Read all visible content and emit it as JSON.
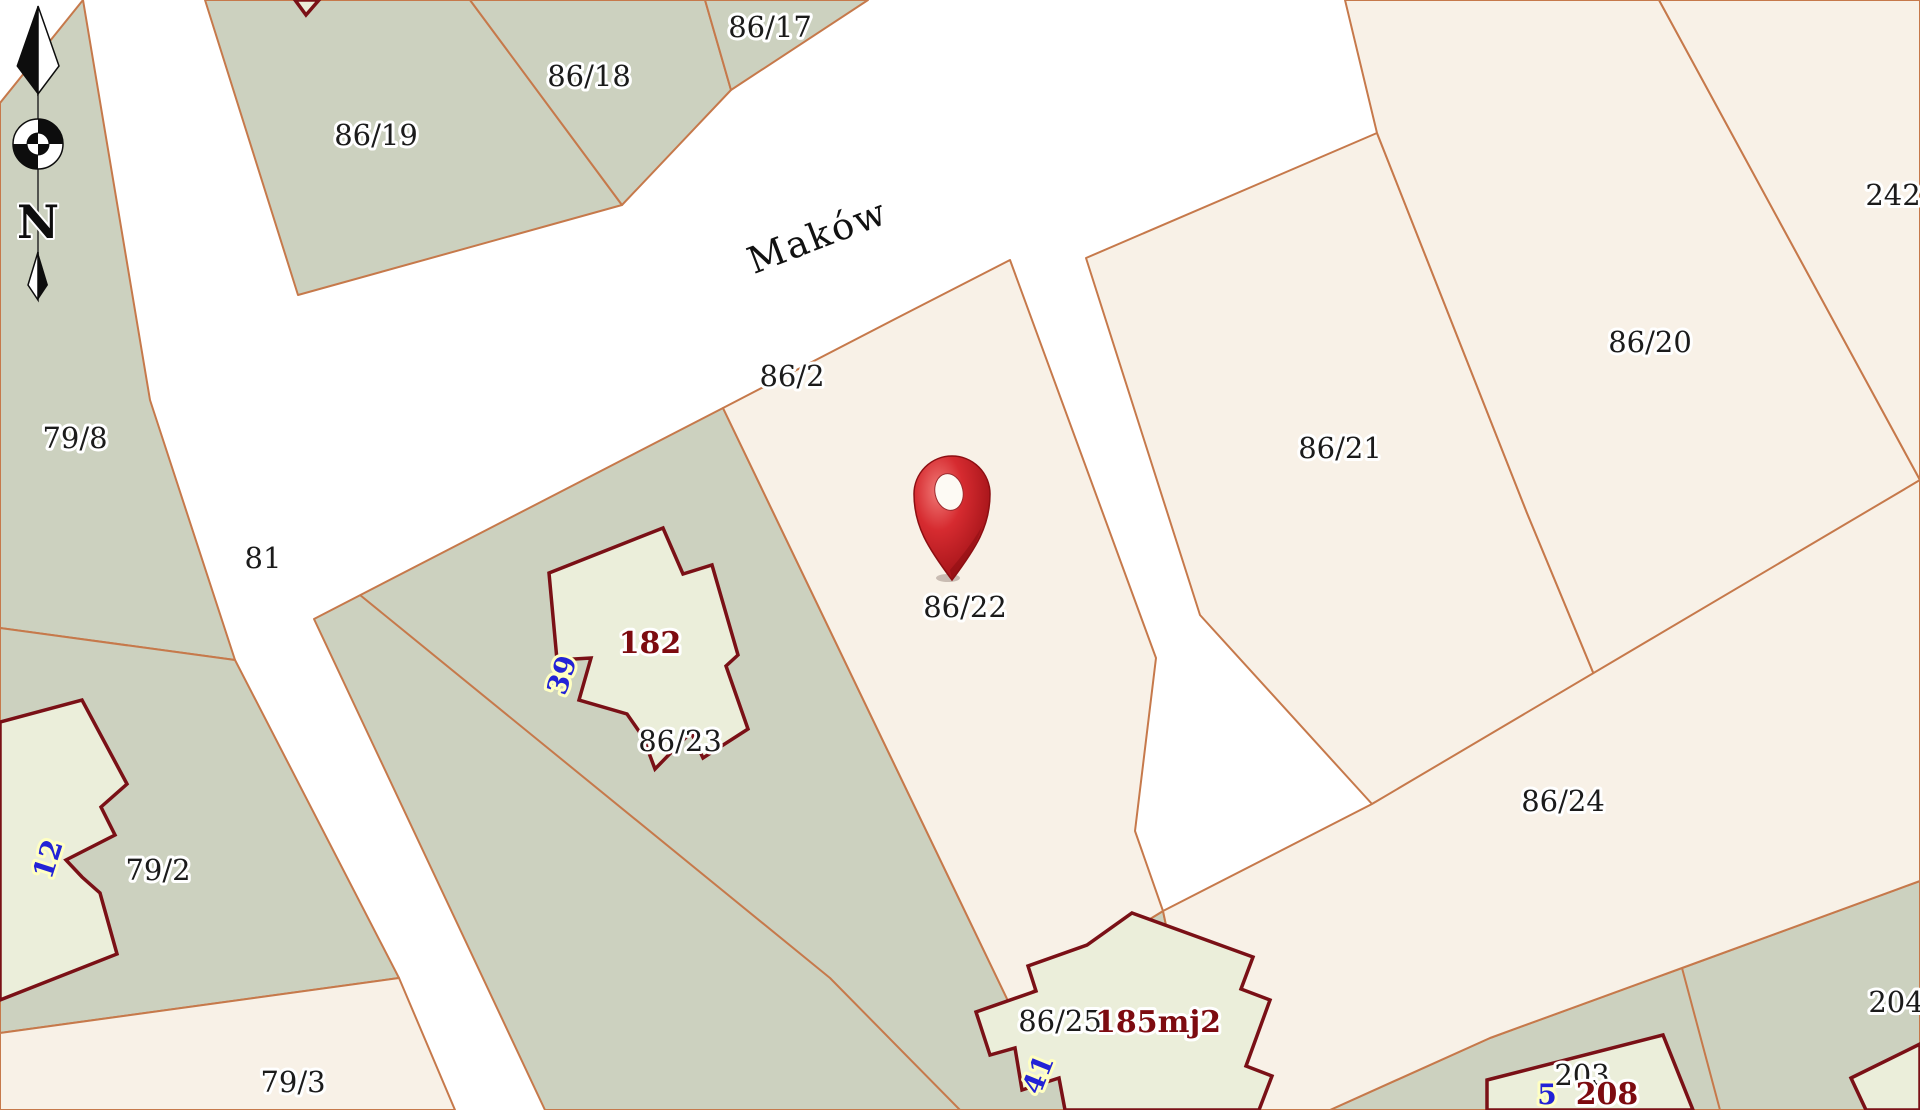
{
  "map": {
    "street_label": "Maków",
    "north_indicator": "N",
    "marked_parcel_label": "86/22",
    "colors": {
      "road_background": "#ffffff",
      "green_parcel": "#ccd1bf",
      "cream_parcel": "#f8f1e7",
      "building_fill": "#ebeeda",
      "boundary_line": "#c6794b",
      "building_outline": "#7a1016",
      "pin_red": "#cf2128",
      "label_black": "#1b1b1b",
      "label_blue": "#2323d6",
      "label_dark_red": "#7d0b10"
    },
    "parcels": [
      {
        "id": "86/19",
        "type": "green",
        "points": "205,0 470,0 622,205 298,295"
      },
      {
        "id": "86/18",
        "type": "green",
        "points": "470,0 705,0 731,90 622,205"
      },
      {
        "id": "86/17",
        "type": "green",
        "points": "705,0 868,0 731,90"
      },
      {
        "id": "79/8",
        "type": "green",
        "points": "0,103 83,0 150,400 235,660 0,628"
      },
      {
        "id": "79/2",
        "type": "green",
        "points": "0,628 235,660 399,978 0,1033"
      },
      {
        "id": "86/23-86/25",
        "type": "green",
        "points": "314,619 723,408 1010,1005 1163,911 1182,1001 1225,1110 545,1110"
      },
      {
        "id": "203-204-block",
        "type": "green",
        "points": "1330,1110 1490,1038 1682,968 1920,881 1920,1110"
      },
      {
        "id": "79/3",
        "type": "cream",
        "points": "0,1033 399,978 455,1110 0,1110"
      },
      {
        "id": "86/22",
        "type": "cream",
        "points": "723,408 897,318 1010,260 1156,658 1135,831 1163,911 1010,1005"
      },
      {
        "id": "86/21",
        "type": "cream",
        "points": "1086,258 1377,133 1527,513 1595,677 1372,804 1200,615"
      },
      {
        "id": "86/20",
        "type": "cream",
        "points": "1345,0 1659,0 1920,480 1595,677 1527,513 1377,133"
      },
      {
        "id": "242",
        "type": "cream",
        "points": "1659,0 1920,0 1920,480"
      },
      {
        "id": "86/24",
        "type": "cream",
        "points": "1163,911 1372,804 1920,480 1920,881 1682,968 1490,1038 1330,1110 1225,1110 1182,1001"
      }
    ],
    "extra_boundaries": [
      {
        "id": "86/23-86/25-split",
        "points": "360,595 830,978 960,1110"
      },
      {
        "id": "203-204-split",
        "points": "1682,968 1720,1110"
      }
    ],
    "buildings": [
      {
        "id": "house-182",
        "points": "549,573 663,528 683,574 712,565 738,655 726,666 748,729 703,758 691,732 655,769 643,737 627,714 579,700 591,658 557,660"
      },
      {
        "id": "house-12",
        "points": "0,722 82,700 127,784 101,807 115,835 66,860 82,877 100,893 117,954 0,1000"
      },
      {
        "id": "house-185mj2",
        "points": "1132,913 1253,957 1241,989 1270,1000 1246,1066 1272,1076 1259,1110 1065,1110 1059,1078 1022,1090 1015,1048 990,1055 976,1012 1036,991 1028,966 1087,945"
      },
      {
        "id": "house-208",
        "points": "1487,1080 1663,1035 1693,1110 1487,1110"
      },
      {
        "id": "house-right-edge",
        "points": "1851,1078 1920,1044 1920,1110 1866,1110"
      },
      {
        "id": "house-top-edge",
        "points": "295,0 319,0 306,15"
      }
    ],
    "labels": [
      {
        "text": "86/19",
        "x": 376,
        "y": 145,
        "rot": 0,
        "style": "parcel"
      },
      {
        "text": "86/18",
        "x": 589,
        "y": 86,
        "rot": 0,
        "style": "parcel"
      },
      {
        "text": "86/17",
        "x": 770,
        "y": 37,
        "rot": 0,
        "style": "parcel"
      },
      {
        "text": "79/8",
        "x": 75,
        "y": 448,
        "rot": 0,
        "style": "parcel"
      },
      {
        "text": "81",
        "x": 263,
        "y": 568,
        "rot": 0,
        "style": "parcel"
      },
      {
        "text": "79/2",
        "x": 158,
        "y": 880,
        "rot": 0,
        "style": "parcel"
      },
      {
        "text": "79/3",
        "x": 293,
        "y": 1092,
        "rot": 0,
        "style": "parcel"
      },
      {
        "text": "86/2",
        "x": 792,
        "y": 386,
        "rot": 0,
        "style": "parcel"
      },
      {
        "text": "86/22",
        "x": 965,
        "y": 617,
        "rot": 0,
        "style": "parcel"
      },
      {
        "text": "86/23",
        "x": 680,
        "y": 751,
        "rot": 0,
        "style": "parcel"
      },
      {
        "text": "86/25",
        "x": 1060,
        "y": 1031,
        "rot": 0,
        "style": "parcel"
      },
      {
        "text": "86/21",
        "x": 1340,
        "y": 458,
        "rot": 0,
        "style": "parcel"
      },
      {
        "text": "86/20",
        "x": 1650,
        "y": 352,
        "rot": 0,
        "style": "parcel"
      },
      {
        "text": "86/24",
        "x": 1563,
        "y": 811,
        "rot": 0,
        "style": "parcel"
      },
      {
        "text": "242",
        "x": 1893,
        "y": 205,
        "rot": 0,
        "style": "parcel"
      },
      {
        "text": "204",
        "x": 1896,
        "y": 1012,
        "rot": 0,
        "style": "parcel"
      },
      {
        "text": "203",
        "x": 1582,
        "y": 1085,
        "rot": 0,
        "style": "parcel"
      },
      {
        "text": "182",
        "x": 650,
        "y": 653,
        "rot": 0,
        "style": "building"
      },
      {
        "text": "185mj2",
        "x": 1158,
        "y": 1032,
        "rot": 0,
        "style": "building"
      },
      {
        "text": "208",
        "x": 1607,
        "y": 1104,
        "rot": 0,
        "style": "building"
      },
      {
        "text": "39",
        "x": 571,
        "y": 678,
        "rot": -72,
        "style": "address"
      },
      {
        "text": "12",
        "x": 57,
        "y": 862,
        "rot": -72,
        "style": "address"
      },
      {
        "text": "41",
        "x": 1047,
        "y": 1078,
        "rot": -68,
        "style": "address"
      },
      {
        "text": "5",
        "x": 1547,
        "y": 1104,
        "rot": 0,
        "style": "address"
      }
    ]
  }
}
